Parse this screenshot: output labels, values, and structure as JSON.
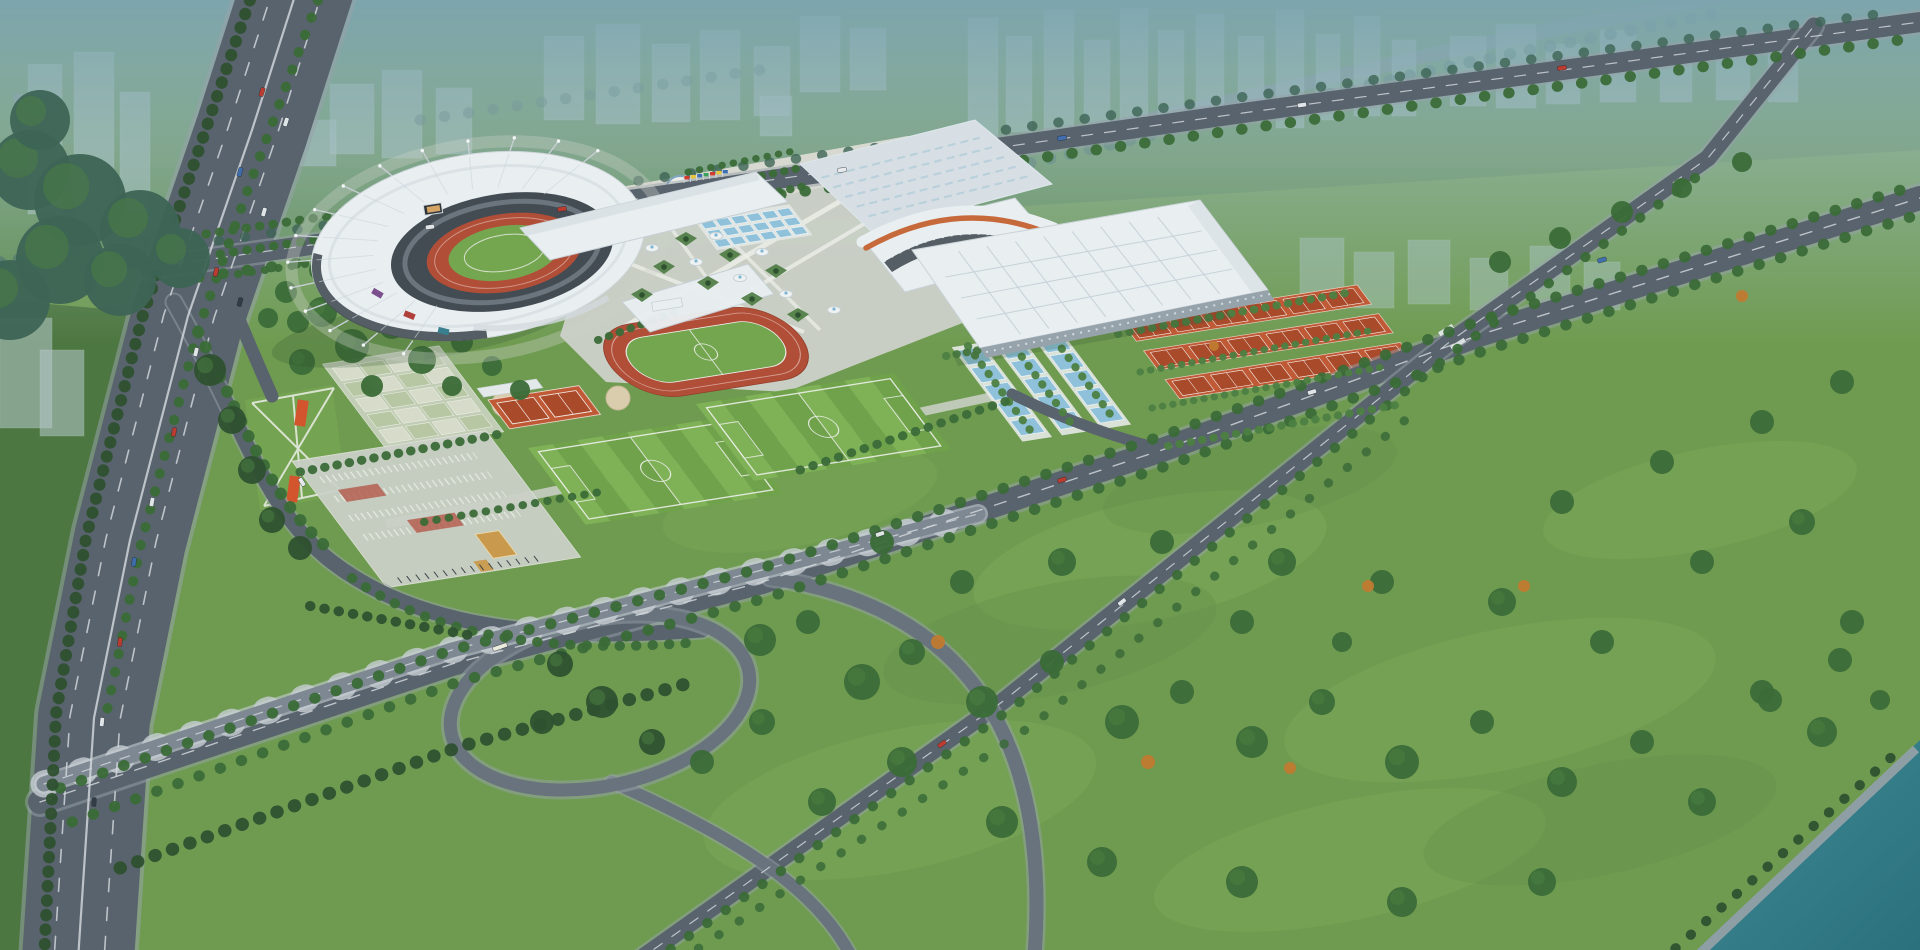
{
  "meta": {
    "description": "Aerial architectural rendering of a large sports-center complex: crescent-roof main stadium with red running track, exhibition and gymnasium halls, outdoor blue courts, orange tennis courts, training track, soccer pitches, entrance plazas, a highway interchange with loop ramp, tree-lined avenues, hazy city blocks on the horizon and a teal river at lower right."
  },
  "colors": {
    "grass": "#6f9b50",
    "grass_north": "#5f8c4c",
    "grass_light": "#82b05c",
    "grass_dark": "#587f41",
    "lawn": "#74a351",
    "forest_west": "#4d7740",
    "tree_dark": "#2e5130",
    "tree_mid": "#3b6b38",
    "tree_light": "#4c7f42",
    "tree_teal": "#3d6455",
    "tree_autumn": "#c07a30",
    "road": "#59636d",
    "road_mid": "#68737d",
    "road_light": "#79838d",
    "road_edge": "#98a2a9",
    "viaduct": "#7e8892",
    "pier": "#c7ced3",
    "dash": "#d6dbde",
    "water": "#3f8d96",
    "water_deep": "#2a6f7c",
    "haze_top": "#7ea6b2",
    "haze_mid": "#9dbcc2",
    "ghost": "#b6c8cd",
    "ghost_glass": "#a9c3bd",
    "ghost_edge": "#e3edf0",
    "roof_white": "#e9eef1",
    "roof_mid": "#d7dfe4",
    "roof_shade": "#c4cfd6",
    "stripe_orange": "#c76a3b",
    "glass_dark": "#3c444c",
    "seat_dark": "#434b53",
    "track_red": "#b04e38",
    "field_green": "#74a64f",
    "pitch_light": "#7fb257",
    "pitch_dark": "#6fa24b",
    "court_blue": "#8fc2da",
    "platform": "#e3e7e3",
    "clay": "#c05a36",
    "clay_dark": "#a94a2b",
    "paving": "#ccd1c9",
    "paving_warm": "#d8d9d0",
    "path": "#eceee8",
    "red_paving": "#b25848",
    "gold": "#c99a4e"
  },
  "stadium": {
    "cx": 478,
    "cy": 247,
    "rx": 170,
    "ry": 94,
    "rot": -9,
    "mast_count": 15,
    "mast_start": 118,
    "mast_step": 14
  },
  "ghost_buildings": [
    [
      28,
      64,
      34,
      150
    ],
    [
      74,
      52,
      40,
      168
    ],
    [
      120,
      92,
      30,
      120
    ],
    [
      0,
      318,
      52,
      110
    ],
    [
      40,
      350,
      44,
      86
    ],
    [
      330,
      84,
      44,
      70
    ],
    [
      382,
      70,
      40,
      88
    ],
    [
      436,
      88,
      36,
      66
    ],
    [
      300,
      120,
      36,
      46
    ],
    [
      544,
      36,
      40,
      84
    ],
    [
      596,
      24,
      44,
      100
    ],
    [
      652,
      44,
      38,
      78
    ],
    [
      700,
      30,
      40,
      90
    ],
    [
      754,
      46,
      36,
      70
    ],
    [
      800,
      16,
      40,
      76
    ],
    [
      850,
      28,
      36,
      62
    ],
    [
      760,
      96,
      32,
      40
    ],
    [
      968,
      18,
      30,
      120
    ],
    [
      1006,
      36,
      26,
      96
    ],
    [
      1044,
      10,
      30,
      128
    ],
    [
      1084,
      40,
      26,
      86
    ],
    [
      1120,
      8,
      28,
      120
    ],
    [
      1158,
      30,
      26,
      90
    ],
    [
      1196,
      14,
      28,
      112
    ],
    [
      1238,
      36,
      26,
      84
    ],
    [
      1276,
      10,
      28,
      118
    ],
    [
      1316,
      34,
      24,
      86
    ],
    [
      1354,
      16,
      26,
      100
    ],
    [
      1392,
      40,
      24,
      76
    ],
    [
      1450,
      36,
      36,
      70
    ],
    [
      1496,
      24,
      40,
      84
    ],
    [
      1546,
      44,
      34,
      60
    ],
    [
      1600,
      30,
      36,
      72
    ],
    [
      1660,
      46,
      32,
      56
    ],
    [
      1716,
      36,
      34,
      64
    ],
    [
      1768,
      52,
      30,
      50
    ]
  ],
  "ghost_glass_slabs": [
    [
      1300,
      238,
      44,
      62
    ],
    [
      1354,
      252,
      40,
      56
    ],
    [
      1408,
      240,
      42,
      64
    ],
    [
      1470,
      258,
      38,
      52
    ],
    [
      1530,
      246,
      40,
      58
    ],
    [
      1584,
      262,
      36,
      48
    ]
  ],
  "meadow_patches": [
    [
      1150,
      560,
      180,
      60,
      0.32,
      "l"
    ],
    [
      1500,
      700,
      220,
      70,
      0.3,
      "l"
    ],
    [
      900,
      800,
      200,
      70,
      0.28,
      "l"
    ],
    [
      1700,
      500,
      160,
      50,
      0.3,
      "l"
    ],
    [
      1350,
      860,
      200,
      60,
      0.26,
      "l"
    ],
    [
      800,
      500,
      140,
      45,
      0.22,
      "l"
    ],
    [
      1050,
      640,
      170,
      55,
      0.18,
      "d"
    ],
    [
      1600,
      820,
      180,
      55,
      0.18,
      "d"
    ],
    [
      1250,
      480,
      150,
      45,
      0.15,
      "d"
    ]
  ],
  "bg_roads": [
    {
      "name": "horizon-expressway",
      "d": "M930,170 L1460,48 L1722,-4",
      "w": 14,
      "c": "road_light",
      "o": 0.8
    },
    {
      "name": "northwest-road",
      "d": "M70,246 L18,98",
      "w": 10,
      "c": "road_light",
      "o": 0.7
    }
  ],
  "bg_tree_rows": [
    {
      "d": "M930,186 L1460,64 L1724,12",
      "w": 12,
      "gap": 20,
      "c": "tree_teal",
      "o": 0.7
    },
    {
      "d": "M420,120 L760,70",
      "w": 11,
      "gap": 24,
      "c": "tree_teal",
      "o": 0.5
    },
    {
      "d": "M0,262 L148,240",
      "w": 11,
      "gap": 18,
      "c": "tree_teal",
      "o": 0.8
    }
  ],
  "roads": [
    {
      "name": "west-highway",
      "d": "M300,-20 L252,130 L188,316 L130,540 L94,718 L78,960",
      "w": 112,
      "c": "road",
      "edge": 8,
      "eo": 0.55
    },
    {
      "name": "highway-exit-ramp",
      "d": "M210,252 C232,302 248,342 272,396",
      "w": 13,
      "c": "road"
    },
    {
      "name": "north-boulevard",
      "d": "M148,268 L700,190 L1250,112 L1920,22",
      "w": 20,
      "c": "road",
      "edge": 5,
      "eo": 0.5
    },
    {
      "name": "west-access-road",
      "d": "M174,302 C246,428 262,508 332,562 C418,628 544,642 702,630",
      "w": 15,
      "c": "road",
      "edge": 4,
      "eo": 0.5
    },
    {
      "name": "south-avenue",
      "d": "M40,802 L452,664 L762,582 L1162,450 L1482,334 L1920,198",
      "w": 24,
      "c": "road",
      "edge": 6,
      "eo": 0.5
    },
    {
      "name": "east-cross-road",
      "d": "M636,962 L1002,702 L1452,340 L1708,158 L1814,26",
      "w": 17,
      "c": "road",
      "edge": 5,
      "eo": 0.5
    },
    {
      "name": "plaza-connector-road",
      "d": "M1012,394 C1064,420 1118,438 1164,450",
      "w": 11,
      "c": "road"
    },
    {
      "name": "loop-ramp-south-1",
      "d": "M770,578 C972,608 1052,744 1034,962",
      "w": 14,
      "c": "road_mid",
      "edge": 5,
      "eo": 0.5
    },
    {
      "name": "loop-ramp-south-2",
      "d": "M612,782 C738,838 820,890 854,962",
      "w": 12,
      "c": "road_mid",
      "edge": 4,
      "eo": 0.5
    },
    {
      "name": "interchange-loop-edge",
      "ellipse": [
        600,
        702,
        152,
        84,
        -12
      ],
      "w": 19,
      "c": "road_edge",
      "o": 0.5
    },
    {
      "name": "interchange-loop",
      "ellipse": [
        600,
        702,
        152,
        84,
        -12
      ],
      "w": 13,
      "c": "road_mid"
    },
    {
      "name": "viaduct-piers",
      "d": "M44,784 L452,650 L762,570 L978,514",
      "w": 27,
      "c": "pier",
      "dash": "3 36",
      "o": 0.8
    },
    {
      "name": "viaduct-edge",
      "d": "M44,784 L452,650 L762,570 L978,514",
      "w": 20,
      "c": "pier",
      "o": 0.6
    },
    {
      "name": "viaduct-deck",
      "d": "M44,784 L452,650 L762,570 L978,514",
      "w": 15,
      "c": "viaduct"
    },
    {
      "name": "viaduct-centerline",
      "d": "M44,784 L452,650 L762,570 L978,514",
      "w": 1.2,
      "c": "dash",
      "dash": "10 10",
      "o": 0.8
    }
  ],
  "lane_dashes": [
    {
      "d": "M326,-20 L278,132 L214,318 L156,542 L120,720 L104,960",
      "w": 1.6,
      "dash": "13 16"
    },
    {
      "d": "M276,-20 L228,128 L164,314 L106,538 L70,716 L54,960",
      "w": 1.6,
      "dash": "13 16"
    },
    {
      "d": "M300,-20 L252,130 L188,316 L130,540 L94,718 L78,960",
      "w": 2.2
    },
    {
      "d": "M148,268 L700,190 L1250,112 L1920,22",
      "w": 1.2,
      "dash": "11 12"
    },
    {
      "d": "M40,802 L452,664 L762,582 L1162,450 L1482,334 L1920,198",
      "w": 1.4,
      "dash": "12 13"
    },
    {
      "d": "M636,962 L1002,702 L1452,340 L1708,158 L1814,26",
      "w": 1.2,
      "dash": "10 12"
    }
  ],
  "tree_rows": [
    {
      "d": "M150,284 L700,206 L1250,128 L1900,40",
      "w": 11,
      "gap": 24
    },
    {
      "d": "M166,248 L700,172 L1250,96 L1880,14",
      "w": 10,
      "gap": 26,
      "c": "tree_teal",
      "o": 0.8
    },
    {
      "d": "M206,234 L560,182",
      "w": 9,
      "gap": 13
    },
    {
      "d": "M220,254 L585,200",
      "w": 9,
      "gap": 13
    },
    {
      "d": "M238,274 L520,232",
      "w": 8,
      "gap": 13
    },
    {
      "d": "M700,208 L806,186",
      "w": 8,
      "gap": 11
    },
    {
      "d": "M694,190 L800,168",
      "w": 8,
      "gap": 11
    },
    {
      "d": "M688,172 L794,151",
      "w": 7,
      "gap": 11
    },
    {
      "d": "M60,788 L452,650 L762,568 L1162,436 L1482,320 L1920,184",
      "w": 11,
      "gap": 22
    },
    {
      "d": "M72,822 L458,682 L766,598 L1166,466 L1486,350 L1920,214",
      "w": 11,
      "gap": 22
    },
    {
      "d": "M652,962 L1012,708 L1456,350 L1698,176",
      "w": 10,
      "gap": 22
    },
    {
      "d": "M678,962 L1034,724 L1420,408",
      "w": 9,
      "gap": 24,
      "o": 0.85
    },
    {
      "d": "M1660,962 L1904,746",
      "w": 10,
      "gap": 20,
      "c": "tree_dark"
    },
    {
      "d": "M318,0 L252,178 L198,330 L140,548 L106,716",
      "w": 10,
      "gap": 18
    },
    {
      "d": "M250,0 L196,158 L142,318 L86,538 L56,714 L44,960",
      "w": 12,
      "gap": 14,
      "c": "tree_dark"
    },
    {
      "d": "M198,332 C252,440 272,502 334,554",
      "w": 12,
      "gap": 16
    },
    {
      "d": "M352,578 C440,640 560,654 700,642",
      "w": 10,
      "gap": 16
    },
    {
      "d": "M946,356 L1205,310",
      "w": 8,
      "gap": 10,
      "c": "tree_light"
    },
    {
      "d": "M1118,334 L1352,292",
      "w": 8,
      "gap": 11,
      "c": "tree_light"
    },
    {
      "d": "M1140,372 L1374,330",
      "w": 7,
      "gap": 10,
      "c": "tree_light"
    },
    {
      "d": "M1152,408 L1388,366",
      "w": 7,
      "gap": 10,
      "c": "tree_light"
    },
    {
      "d": "M1168,446 L1402,404",
      "w": 8,
      "gap": 11,
      "c": "tree_light"
    },
    {
      "d": "M968,346 L1030,430",
      "w": 8,
      "gap": 11,
      "c": "tree_light"
    },
    {
      "d": "M1008,338 L1070,422",
      "w": 8,
      "gap": 11,
      "c": "tree_light"
    },
    {
      "d": "M1048,330 L1110,414",
      "w": 8,
      "gap": 11,
      "c": "tree_light"
    },
    {
      "d": "M120,868 L462,746 L700,680",
      "w": 13,
      "gap": 18,
      "c": "tree_dark"
    },
    {
      "d": "M310,606 L474,636",
      "w": 10,
      "gap": 14,
      "c": "tree_dark"
    },
    {
      "d": "M300,472 L500,434",
      "w": 9,
      "gap": 12
    },
    {
      "d": "M424,522 L600,492",
      "w": 8,
      "gap": 12
    },
    {
      "d": "M800,470 L1010,400",
      "w": 9,
      "gap": 13
    },
    {
      "d": "M598,340 L676,312",
      "w": 8,
      "gap": 11
    }
  ],
  "tree_clumps": [
    [
      322,
      312,
      15
    ],
    [
      352,
      346,
      17
    ],
    [
      392,
      326,
      13
    ],
    [
      422,
      360,
      14
    ],
    [
      302,
      362,
      13
    ],
    [
      432,
      302,
      11
    ],
    [
      462,
      342,
      11
    ],
    [
      298,
      322,
      11
    ],
    [
      372,
      386,
      11
    ],
    [
      452,
      386,
      10
    ],
    [
      492,
      366,
      10
    ],
    [
      520,
      390,
      10
    ],
    [
      320,
      270,
      11
    ],
    [
      350,
      248,
      10
    ],
    [
      286,
      292,
      11
    ],
    [
      268,
      318,
      10
    ],
    [
      602,
      702,
      16,
      "tree_dark"
    ],
    [
      560,
      664,
      13,
      "tree_dark"
    ],
    [
      652,
      742,
      13,
      "tree_dark"
    ],
    [
      542,
      722,
      12,
      "tree_dark"
    ],
    [
      760,
      640,
      16
    ],
    [
      808,
      622,
      12
    ],
    [
      862,
      682,
      18
    ],
    [
      912,
      652,
      13
    ],
    [
      982,
      702,
      16
    ],
    [
      1052,
      662,
      12
    ],
    [
      1122,
      722,
      17
    ],
    [
      1182,
      692,
      12
    ],
    [
      1252,
      742,
      16
    ],
    [
      1322,
      702,
      13
    ],
    [
      1402,
      762,
      17
    ],
    [
      1482,
      722,
      12
    ],
    [
      1562,
      782,
      15
    ],
    [
      1642,
      742,
      12
    ],
    [
      1702,
      802,
      14
    ],
    [
      1762,
      692,
      12
    ],
    [
      1822,
      732,
      15
    ],
    [
      1602,
      642,
      12
    ],
    [
      1502,
      602,
      14
    ],
    [
      1382,
      582,
      12
    ],
    [
      1282,
      562,
      14
    ],
    [
      1162,
      542,
      12
    ],
    [
      1062,
      562,
      14
    ],
    [
      962,
      582,
      12
    ],
    [
      882,
      542,
      12
    ],
    [
      1702,
      562,
      12
    ],
    [
      1802,
      522,
      13
    ],
    [
      1852,
      622,
      12
    ],
    [
      1562,
      502,
      12
    ],
    [
      1662,
      462,
      12
    ],
    [
      1762,
      422,
      12
    ],
    [
      1842,
      382,
      12
    ],
    [
      1242,
      622,
      12
    ],
    [
      1342,
      642,
      10
    ],
    [
      902,
      762,
      15
    ],
    [
      1002,
      822,
      16
    ],
    [
      1102,
      862,
      15
    ],
    [
      1242,
      882,
      16
    ],
    [
      1402,
      902,
      15
    ],
    [
      1542,
      882,
      14
    ],
    [
      762,
      722,
      13
    ],
    [
      822,
      802,
      14
    ],
    [
      702,
      762,
      12
    ],
    [
      30,
      170,
      40,
      "tree_teal"
    ],
    [
      80,
      200,
      46,
      "tree_teal"
    ],
    [
      140,
      230,
      40,
      "tree_teal"
    ],
    [
      60,
      260,
      44,
      "tree_teal"
    ],
    [
      10,
      300,
      40,
      "tree_teal"
    ],
    [
      120,
      280,
      36,
      "tree_teal"
    ],
    [
      180,
      258,
      30,
      "tree_teal"
    ],
    [
      40,
      120,
      30,
      "tree_teal"
    ],
    [
      210,
      370,
      16,
      "tree_dark"
    ],
    [
      232,
      420,
      14,
      "tree_dark"
    ],
    [
      252,
      470,
      14,
      "tree_dark"
    ],
    [
      272,
      520,
      13,
      "tree_dark"
    ],
    [
      300,
      548,
      12,
      "tree_dark"
    ],
    [
      1770,
      700,
      12
    ],
    [
      1840,
      660,
      12
    ],
    [
      1880,
      700,
      10
    ],
    [
      1500,
      262,
      11
    ],
    [
      1560,
      238,
      11
    ],
    [
      1622,
      212,
      11
    ],
    [
      1682,
      188,
      10
    ],
    [
      1742,
      162,
      10
    ],
    [
      938,
      642,
      7,
      "tree_autumn"
    ],
    [
      1148,
      762,
      7,
      "tree_autumn"
    ],
    [
      1368,
      586,
      6,
      "tree_autumn"
    ],
    [
      1524,
      586,
      6,
      "tree_autumn"
    ],
    [
      1214,
      346,
      5,
      "tree_autumn"
    ],
    [
      1742,
      296,
      6,
      "tree_autumn"
    ],
    [
      1290,
      768,
      6,
      "tree_autumn"
    ]
  ],
  "cars": [
    [
      262,
      92,
      108,
      "#c0392c"
    ],
    [
      286,
      122,
      108,
      "#e8ecee"
    ],
    [
      240,
      172,
      106,
      "#3e6db0"
    ],
    [
      264,
      212,
      106,
      "#e8ecee"
    ],
    [
      216,
      272,
      104,
      "#c0392c"
    ],
    [
      240,
      302,
      104,
      "#2f3a42"
    ],
    [
      196,
      352,
      103,
      "#e8ecee"
    ],
    [
      174,
      432,
      101,
      "#c0392c"
    ],
    [
      152,
      502,
      100,
      "#e8ecee"
    ],
    [
      134,
      562,
      99,
      "#3e6db0"
    ],
    [
      120,
      642,
      97,
      "#c0392c"
    ],
    [
      102,
      722,
      96,
      "#e8ecee"
    ],
    [
      94,
      802,
      94,
      "#2f3a42"
    ],
    [
      430,
      227,
      -8,
      "#e8ecee"
    ],
    [
      562,
      209,
      -8,
      "#c0392c"
    ],
    [
      842,
      170,
      -8,
      "#e8ecee"
    ],
    [
      1062,
      138,
      -8,
      "#3e6db0"
    ],
    [
      1302,
      105,
      -8,
      "#e8ecee"
    ],
    [
      1562,
      68,
      -8,
      "#c0392c"
    ],
    [
      880,
      534,
      -19,
      "#e8ecee"
    ],
    [
      1062,
      480,
      -18,
      "#c0392c"
    ],
    [
      1312,
      392,
      -17,
      "#e8ecee"
    ],
    [
      1602,
      260,
      -16,
      "#3e6db0"
    ],
    [
      500,
      647,
      -19,
      "#edeede",
      15
    ],
    [
      1122,
      602,
      -39,
      "#e8ecee"
    ],
    [
      942,
      744,
      -36,
      "#c0392c"
    ],
    [
      302,
      482,
      58,
      "#e8ecee"
    ]
  ],
  "crosswalks": [
    [
      1446,
      330,
      -32
    ],
    [
      1458,
      344,
      -32
    ]
  ],
  "flags": {
    "x": 684,
    "y": 183,
    "dx": 6.4,
    "dy": -1.0,
    "colors": [
      "#d23b2f",
      "#e8c63a",
      "#3c6fb3",
      "#3aa05a",
      "#d23b2f",
      "#e8c63a",
      "#3c6fb3"
    ]
  },
  "fountains": [
    [
      652,
      248
    ],
    [
      696,
      262
    ],
    [
      740,
      278
    ],
    [
      786,
      294
    ],
    [
      834,
      310
    ],
    [
      716,
      236
    ],
    [
      762,
      252
    ]
  ],
  "planter_diamonds": [
    [
      664,
      268
    ],
    [
      708,
      284
    ],
    [
      752,
      300
    ],
    [
      798,
      316
    ],
    [
      686,
      240
    ],
    [
      730,
      256
    ],
    [
      776,
      272
    ],
    [
      642,
      296
    ]
  ],
  "fields": {
    "axis": {
      "u": [
        0.988,
        -0.156
      ],
      "v": [
        0.6,
        0.8
      ]
    },
    "soccer": [
      {
        "o": [
          528,
          448
        ]
      },
      {
        "o": [
          696,
          404
        ]
      }
    ],
    "track": {
      "o": [
        706,
        352
      ]
    },
    "clay": {
      "o": [
        488,
        400
      ]
    },
    "gateball": {
      "o": [
        332,
        368
      ],
      "cols": 4,
      "rows": 5
    },
    "courts_blue": {
      "o": [
        957,
        350
      ],
      "strips": 3,
      "per": 5
    },
    "tennis": {
      "o": [
        1122,
        322
      ],
      "rows": 3,
      "per": 6
    },
    "pools": {
      "o": [
        700,
        222
      ],
      "cols": 6,
      "rows": 3
    },
    "south_plaza": {
      "o": [
        306,
        468
      ]
    }
  }
}
